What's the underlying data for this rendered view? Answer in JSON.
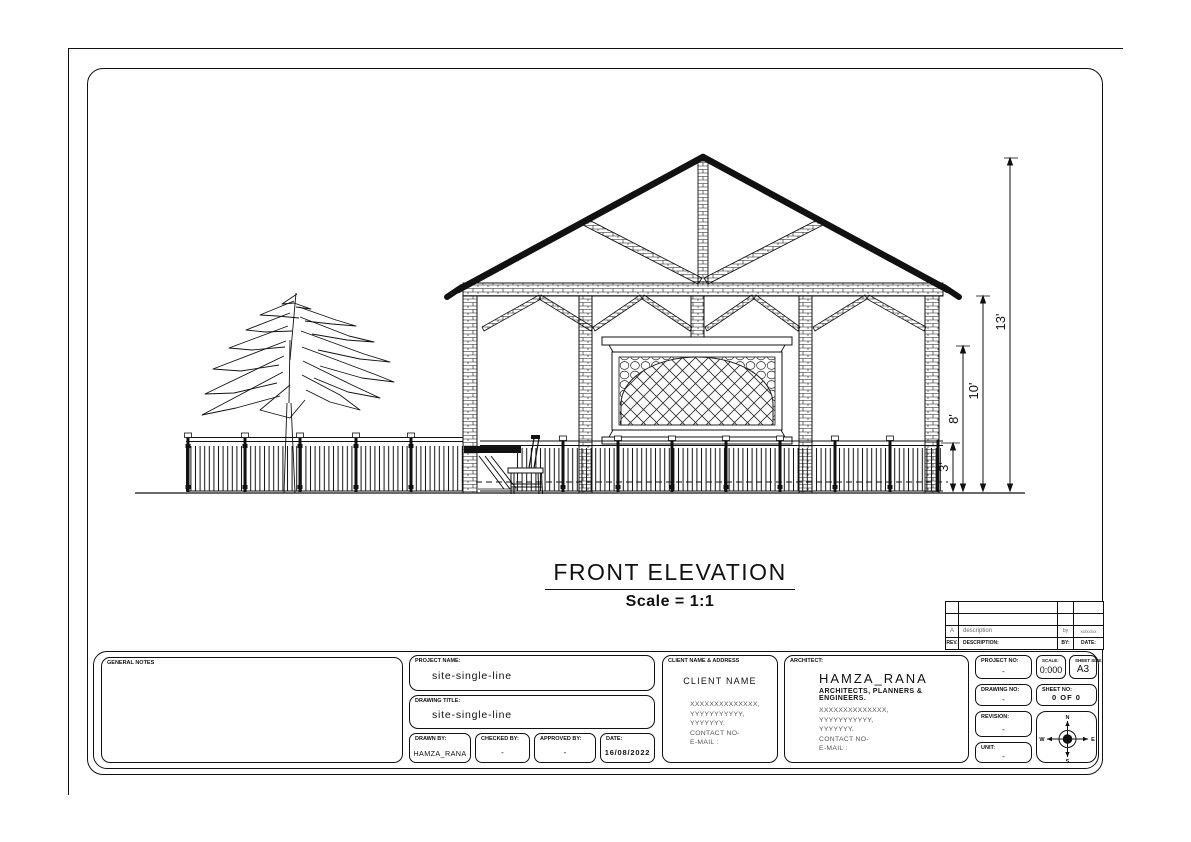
{
  "drawing": {
    "title": "FRONT ELEVATION",
    "scale_note": "Scale = 1:1",
    "dimensions": {
      "d3": "3'",
      "d8": "8'",
      "d10": "10'",
      "d13": "13'"
    }
  },
  "revision_table": {
    "header": {
      "rev": "REV.",
      "description": "DESCRIPTION:",
      "by": "BY:",
      "date": "DATE:"
    },
    "row": {
      "rev": "A",
      "description": "description",
      "by": "by",
      "date": "xx/xx/xx"
    }
  },
  "title_block": {
    "general_notes_label": "GENERAL NOTES",
    "project_name": {
      "label": "PROJECT NAME:",
      "value": "site-single-line"
    },
    "drawing_title": {
      "label": "DRAWING TITLE:",
      "value": "site-single-line"
    },
    "drawn_by": {
      "label": "DRAWN BY:",
      "value": "HAMZA_RANA"
    },
    "checked_by": {
      "label": "CHECKED BY:",
      "value": "-"
    },
    "approved_by": {
      "label": "APPROVED BY:",
      "value": "-"
    },
    "date": {
      "label": "DATE:",
      "value": "16/08/2022"
    },
    "client": {
      "label": "CLIENT NAME & ADDRESS",
      "name": "CLIENT NAME",
      "address_lines": [
        "XXXXXXXXXXXXXX,",
        "YYYYYYYYYYY,",
        "YYYYYYY.",
        "CONTACT NO-",
        "E-MAIL :"
      ]
    },
    "architect": {
      "label": "ARCHITECT:",
      "name": "HAMZA_RANA",
      "subtitle": "ARCHITECTS, PLANNERS & ENGINEERS.",
      "address_lines": [
        "XXXXXXXXXXXXXX,",
        "YYYYYYYYYYY,",
        "YYYYYYY.",
        "CONTACT NO-",
        "E-MAIL :"
      ]
    },
    "project_no": {
      "label": "PROJECT NO:",
      "value": "-"
    },
    "scale": {
      "label": "SCALE:",
      "value": "0:000"
    },
    "sheet_size": {
      "label": "SHEET SIZE:",
      "value": "A3"
    },
    "drawing_no": {
      "label": "DRAWING NO:",
      "value": "-"
    },
    "sheet_no": {
      "label": "SHEET NO:",
      "value": "0 OF 0"
    },
    "revision": {
      "label": "REVISION:",
      "value": "-"
    },
    "unit": {
      "label": "UNIT:",
      "value": "-"
    },
    "compass": {
      "n": "N",
      "e": "E",
      "s": "S",
      "w": "W"
    }
  }
}
